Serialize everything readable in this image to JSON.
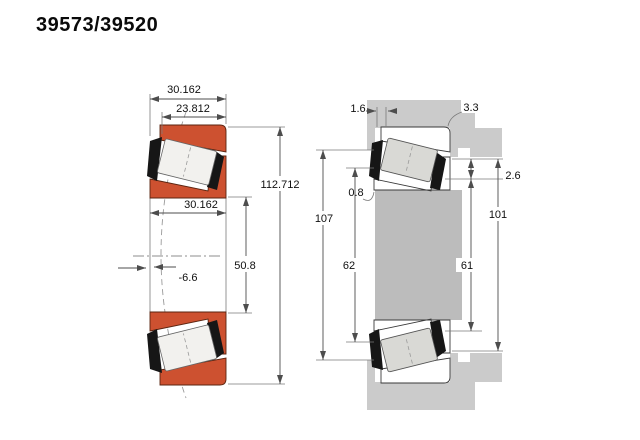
{
  "page": {
    "title": "39573/39520"
  },
  "colors": {
    "ring_orange": "#cd5130",
    "ring_edge": "#5a2410",
    "roller_light": "#f2f1ee",
    "roller_gray": "#d9d9d5",
    "cage_black": "#161616",
    "housing_gray": "#cbcbcb",
    "shaft_gray": "#bcbcbc",
    "dim_line": "#4d4d4d",
    "text": "#101010"
  },
  "left_view": {
    "description": "bearing cross-section",
    "dims": {
      "total_width": "30.162",
      "cup_width": "23.812",
      "outer_diameter": "112.712",
      "cone_width": "30.162",
      "bore_diameter": "50.8",
      "load_center": "-6.6"
    }
  },
  "right_view": {
    "description": "mounting abutment view",
    "dims": {
      "face_offset_top": "1.6",
      "fillet_radius_housing": "3.3",
      "fillet_radius_shaft": "0.8",
      "face_offset_side": "2.6",
      "housing_recess_diameter": "107",
      "shaft_shoulder_diameter": "62",
      "backing_shoulder_diameter": "61",
      "housing_shoulder_diameter": "101"
    }
  }
}
